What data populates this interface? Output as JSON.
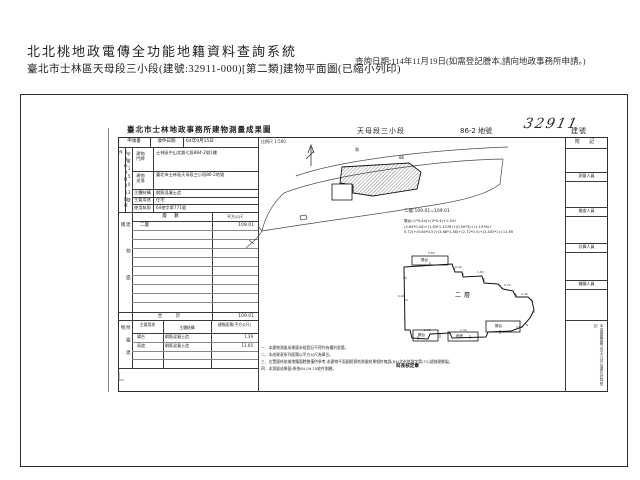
{
  "header": {
    "system_title": "北北桃地政電傳全功能地籍資料查詢系統",
    "subtitle": "臺北市士林區天母段三小段(建號:32911-000)[第二類]建物平面圖(已縮小列印)",
    "query_date": "查詢日期:114年11月19日(如需登記謄本,請向地政事務所申請。)"
  },
  "sheet": {
    "title": "臺北市士林地政事務所建物測量成果圖",
    "section_name": "天母段三小段",
    "lot_label": "86-2 地號",
    "building_no_handwritten": "32911",
    "building_no_suffix": "建號",
    "scale_label": "比例尺 1:500"
  },
  "form": {
    "application_label": "申請書",
    "received_label": "收件日期",
    "received_value": "64年9月15日",
    "received_vertical": "64年9月15日收件",
    "docket_vertical": "字第1503號",
    "rows": [
      {
        "label": "建物門牌",
        "value": "士林區中山北路七段884-2號1樓"
      },
      {
        "label": "建物坐落",
        "value": "臺北市士林區天母段三小段86-2地號"
      },
      {
        "label": "主體結構",
        "value": "鋼筋混凝土造"
      },
      {
        "label": "主要用途",
        "value": "住宅"
      },
      {
        "label": "使用執照",
        "value": "64使字第771號"
      }
    ]
  },
  "area_table": {
    "side_label": "建物面積",
    "col_floor": "層 數",
    "col_unit": "平方公尺",
    "rows": [
      {
        "floor": "二層",
        "area": "109.01"
      }
    ],
    "total_label": "合 計",
    "total_value": "109.01"
  },
  "annex_table": {
    "side_label": "附屬建物",
    "col_use": "主要用途",
    "col_structure": "主體結構",
    "col_area": "建物面積(平方公尺)",
    "rows": [
      {
        "use": "陽台",
        "structure": "鋼筋混凝土造",
        "area": "1.39"
      },
      {
        "use": "雨遮",
        "structure": "鋼筋混凝土造",
        "area": "11.65"
      }
    ]
  },
  "notes": [
    "一、本建物測量成果圖未經登記不得作為權利憑證。",
    "二、本成果表所列面積以平方公尺為單位。",
    "三、位置圖係依據地籍圖謄繪僅供參考,本建物平面圖經實地測量結果相符無誤(64)北市地測字第(71)號辦理繪製。",
    "四、本測量成果圖:係依64.09.15收件測繪。"
  ],
  "stamp_text": "科長核定章",
  "calc": {
    "lines": [
      "二層:109.01=109.01",
      "陽台:(1*0.44)+(2*0.4)+1.34+",
      "(3.65*0.44)+(1.63*1.1078)+(0.50*3)+(1.1978)+",
      "0.72)+(0.64*0.5)+(3.68*1.36)+(2.72*0.5)+(2.405*1)=11.65"
    ]
  },
  "map": {
    "road_tag": "和",
    "lot_tag": "86"
  },
  "plan": {
    "floor_label": "二層",
    "labels": {
      "balcony_tl": "陽台",
      "balcony_bl": "陽台",
      "canopy": "雨遮",
      "balcony_br": "陽台"
    },
    "dims": [
      "3.65",
      "0.44",
      "1.63",
      "0.72",
      "2.40",
      "3.68",
      "1.34",
      "2.72",
      "0.64"
    ]
  },
  "right_strip": {
    "note_label": "附 記",
    "cells": [
      "測量人員",
      "檢查人員",
      "計算人員",
      "繪圖人員"
    ],
    "bottom_note": "本成果圖面積以平方公尺為單位計算登記"
  },
  "colors": {
    "paper": "#ffffff",
    "ink": "#1f1f1f",
    "scan_line": "#3a3a3a"
  }
}
